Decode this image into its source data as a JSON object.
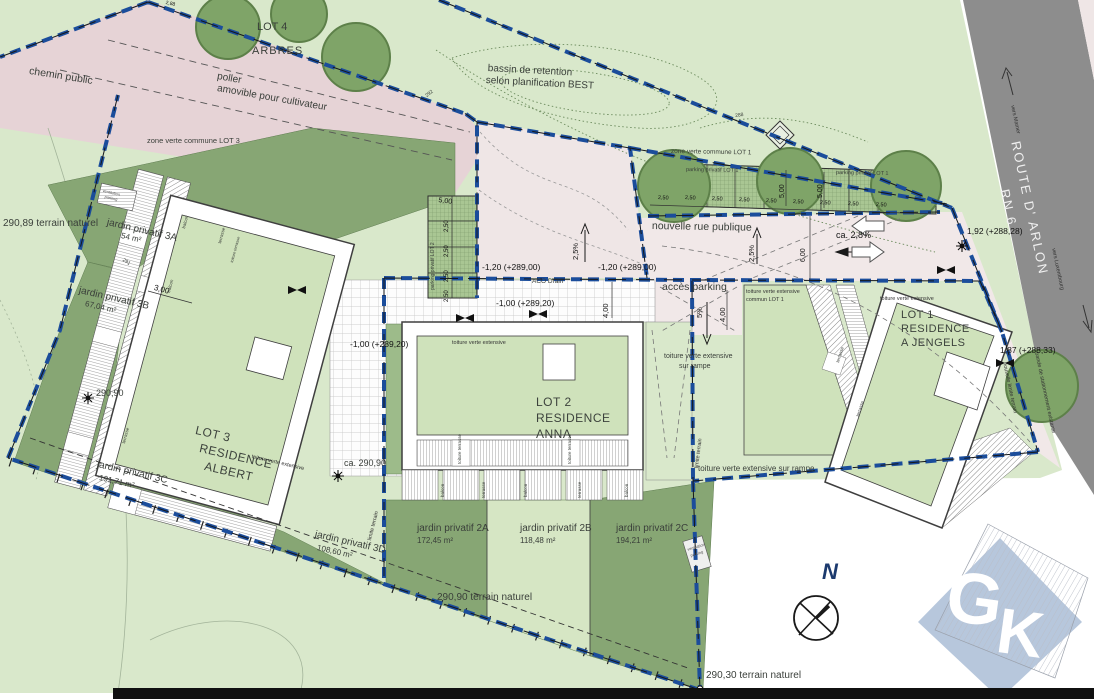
{
  "labels": {
    "lot4": "LOT 4",
    "arbres": "ARBRES",
    "chemin_public": "chemin public",
    "poller_1": "poller",
    "poller_2": "amovible pour cultivateur",
    "zone_verte_lot3": "zone verte commune LOT 3",
    "bassin_1": "bassin de retention",
    "bassin_2": "selon planification BEST",
    "niveau_290_89": "290,89 terrain naturel",
    "jardin_3a": "jardin privatif 3A",
    "jardin_3a_m2": "54 m²",
    "jardin_3b": "jardin privatif 3B",
    "jardin_3b_m2": "67,04 m²",
    "jardin_3c": "jardin privatif 3C",
    "jardin_3c_m2": "191,71 m²",
    "jardin_3d": "jardin privatif 3D",
    "jardin_3d_m2": "108,60 m²",
    "lot3_1": "LOT 3",
    "lot3_2": "RESIDENCE",
    "lot3_3": "ALBERT",
    "lot2_1": "LOT 2",
    "lot2_2": "RESIDENCE",
    "lot2_3": "ANNA",
    "lot1_1": "LOT 1",
    "lot1_2": "RESIDENCE",
    "lot1_3": "A JENGELS",
    "toiture_verte_extensive": "toiture verte extensive",
    "toiture_commun_2": "commun LOT 1",
    "toiture_rampe_2": "sur rampe",
    "toiture_rampe_long": "toiture verte extensive sur rampe",
    "jardin_2a": "jardin privatif 2A",
    "jardin_2a_m2": "172,45 m²",
    "jardin_2b": "jardin privatif 2B",
    "jardin_2b_m2": "118,48 m²",
    "jardin_2c": "jardin privatif 2C",
    "jardin_2c_m2": "194,21 m²",
    "niveau_290_90": "290,90",
    "niveau_ca_290_90": "ca. 290,90",
    "niveau_290_90_tn": "290,90 terrain naturel",
    "niveau_290_30_tn": "290,30 terrain naturel",
    "nouvelle_rue": "nouvelle rue publique",
    "acces_parking": "accès parking",
    "zone_verte_lot1": "zone verte commune LOT 1",
    "parking_privatif_lot1": "parking privatif LOT 1",
    "parking_privatif_lot2": "parking privatif LOT 2",
    "route_arlon": "ROUTE D' ARLON",
    "rn6": "RN 6",
    "vers_mamer": "vers Mamer",
    "vers_luxembourg": "vers Luxembourg",
    "cote_120_289": "-1,20 (+289,00)",
    "cote_100_289": "-1,00 (+289,20)",
    "cote_192": "1,92 (+288,28)",
    "cote_187": "1,87 (+288,33)",
    "aco_drain": "ACO Drain",
    "dim_5_00": "5,00",
    "dim_2_50": "2,50",
    "dim_6_00": "6,00",
    "dim_4_00": "4,00",
    "dim_3_00": "3,00",
    "dim_2_88": "2,88",
    "pente_2_5": "2,5%",
    "pente_ca_2_8": "ca. 2,8%",
    "pente_5": "5%",
    "limite_terrain": "limite terrain",
    "bande_stationnement": "bande de stationnement existante",
    "nouvelle_limite": "nouvelle limite terrain",
    "ventilation_1": "ventilation",
    "ventilation_2": "parking",
    "balcon": "balcon",
    "terrasse": "terrasse",
    "toiture_terrasse": "toiture terrasse",
    "contour_288": "288",
    "contour_291": "291",
    "contour_292": "292",
    "north": "N",
    "logo_g": "G",
    "logo_k": "K"
  },
  "colors": {
    "boundary_blue": "#1b4d9b",
    "road_gray": "#8d8d8d",
    "chemin_pink": "#e6d3d6",
    "rue_pink": "#f1e8e8",
    "terrain_light": "#d9e8cb",
    "jardin_dark": "#87a674",
    "roof_green": "#cfe2bb",
    "parking_green": "#a9c693",
    "logo_blue": "#b7c7dc"
  }
}
